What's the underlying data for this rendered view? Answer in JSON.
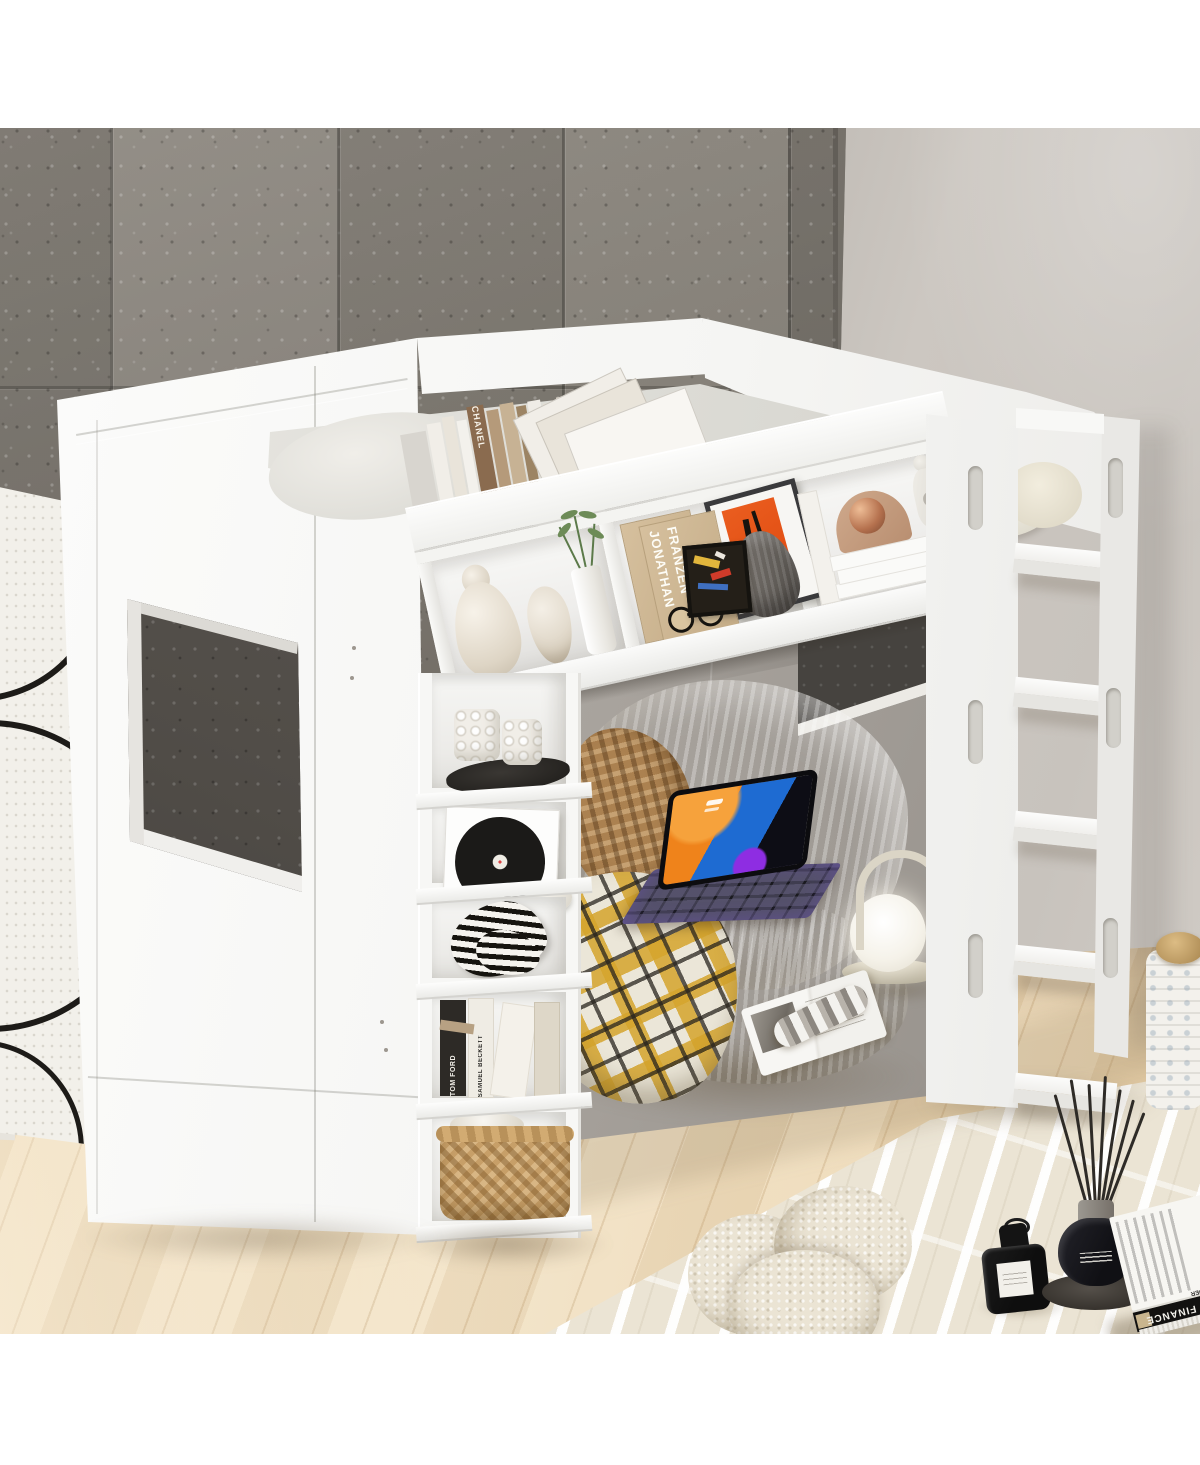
{
  "image": {
    "type": "furniture product photograph",
    "subject": "White loft bed with built-in bookshelves, side ladder and cozy under-bed lounge nook",
    "setting": "Room with gray slate tile wall, warm light-gray wall, light oak wood floor and cream area rug"
  },
  "texts": {
    "chanel_spine": "CHANEL",
    "franzen_first": "JONATHAN",
    "franzen_last": "FRANZEN",
    "tom_ford_spine": "TOM FORD",
    "beckett_spine": "SAMUEL BECKETT",
    "breuer_cover": "BREUER",
    "breuer_spine_title": "WALTER FINANCE",
    "breuer_spine_author": "MARCEL BREUER"
  },
  "palette": {
    "stone_wall": "#868179",
    "side_wall": "#c9c4be",
    "floor_wood": "#edd8b4",
    "bed_white": "#f7f7f5",
    "rug_cream": "#ebe4d4",
    "beanbag_beige": "#d6d0c2",
    "plaid_yellow": "#d5a42c",
    "rattan_brown": "#ab8150",
    "ipad_orange": "#ef831b",
    "ipad_blue": "#1e6bd2",
    "ipad_purple": "#8e2de2",
    "copper": "#b5714e",
    "basket_tan": "#c79f68"
  },
  "objects": [
    "white loft bed frame",
    "playhouse window cutout",
    "top guardrail bookshelf",
    "row of hardcover books",
    "leaning photo books",
    "ceramic gourd vase",
    "bud vase",
    "cylinder vase with green plant",
    "Jonathan Franzen novels",
    "framed orange abstract art",
    "small colorful framed print",
    "gray ribbed vase",
    "stack of white books",
    "copper sphere ornament",
    "white abstract figurine",
    "vertical storage column",
    "bubble cube candles on black tray",
    "framed vinyl record",
    "white ceramic bowl",
    "black-and-white squiggle vase",
    "upside-down designer books",
    "wicker storage basket",
    "side ladder with cutout handles",
    "bed pillow",
    "gray interior back panel with window",
    "striped bean bag lounger",
    "rattan woven pillow",
    "yellow plaid blanket",
    "tablet with backlit keyboard",
    "portable lantern lamp",
    "open magazine",
    "rolled magazine",
    "cream area rug",
    "knot pillow",
    "black perfume bottle",
    "black reed diffuser on tray",
    "architecture coffee-table book",
    "leaning abstract line-art canvases",
    "speckled storage basket with wood lid"
  ]
}
